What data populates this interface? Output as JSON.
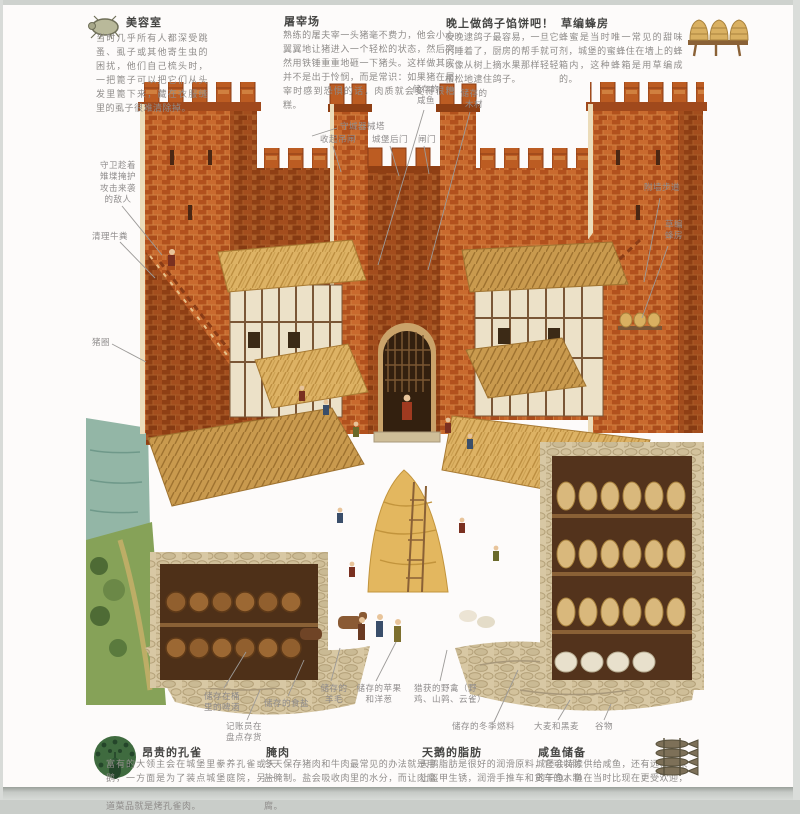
{
  "colors": {
    "brick": "#c9742f",
    "brick_dark": "#a85424",
    "thatch": "#dcb162",
    "stone": "#d6c6a2",
    "grass": "#7d9a50",
    "water": "#8fb3a3",
    "title_text": "#454543",
    "body_text": "#8f8c8a"
  },
  "sections": {
    "beauty": {
      "title": "美容室",
      "icon": "louse-icon",
      "body": "当时几乎所有人都深受跳蚤、虱子或其他寄生虫的困扰，他们自己梳头时，一把篦子可以把它们从头发里篦下来，藏在衣服缝里的虱子很难清除掉。"
    },
    "slaughter": {
      "title": "屠宰场",
      "body": "熟练的屠夫宰一头猪毫不费力，他会小心翼翼地让猪进入一个轻松的状态，然后突然用铁锤重重地砸一下猪头。这样做其实并不是出于怜悯，而是常识：如果猪在屠宰时感到恐惧的话，肉质就会变得很糟糕。"
    },
    "pigeon_pie": {
      "title": "晚上做鸽子馅饼吧！",
      "body": "夜晚逮鸽子最容易，一旦它们睡着了，厨房的帮手就可以像从树上摘水果那样轻轻松松地逮住鸽子。"
    },
    "beehive": {
      "title": "草编蜂房",
      "icon": "beehives-icon",
      "body": "蜂蜜是当时唯一常见的甜味剂，城堡的蜜蜂住在墙上的蜂箱内，这种蜂箱是用草编成的。"
    },
    "peacock": {
      "title": "昂贵的孔雀",
      "icon": "peacock-icon",
      "body": "富有的大领主会在城堡里豢养孔雀或天鹅，一方面是为了装点城堡庭院，另一方面是为了食用，宴会上最受欢迎的一道菜品就是烤孔雀肉。"
    },
    "salted_meat": {
      "title": "腌肉",
      "body": "冬天保存猪肉和牛肉最常见的办法就是用盐腌制。盐会吸收肉里的水分，而让肉腐烂的微生物离不开水分，因此盐可以防腐。"
    },
    "swan_fat": {
      "title": "天鹅的脂肪",
      "body": "天鹅脂肪是很好的润滑原料，它可以防止盔甲生锈，润滑手推车和货车的木制车轴。"
    },
    "salted_fish": {
      "title": "咸鱼储备",
      "icon": "fish-bundle-icon",
      "body": "城堡会持续供给咸鱼，还有远程运来的干鱼。鱼在当时比现在更受欢迎，人们吃鱼的次数几乎和吃肉一样多。"
    }
  },
  "callouts": [
    {
      "text": "守卫趁着\n雉堞掩护\n攻击来袭\n的敌人"
    },
    {
      "text": "清理牛粪"
    },
    {
      "text": "猪圈"
    },
    {
      "text": "守城器械塔"
    },
    {
      "text": "收起吊闸"
    },
    {
      "text": "城堡后门"
    },
    {
      "text": "闸门"
    },
    {
      "text": "储存的\n咸鱼"
    },
    {
      "text": "储存的\n木材"
    },
    {
      "text": "附墙步道"
    },
    {
      "text": "草编\n蜂房"
    },
    {
      "text": "储存在桶\n里的啤酒"
    },
    {
      "text": "记账员在\n盘点存货"
    },
    {
      "text": "储存的食盐"
    },
    {
      "text": "储存的\n羊毛"
    },
    {
      "text": "储存的苹果\n和洋葱"
    },
    {
      "text": "猎获的野禽（野\n鸡、山鹑、云雀）"
    },
    {
      "text": "储存的冬季燃料"
    },
    {
      "text": "大麦和黑麦"
    },
    {
      "text": "谷物"
    }
  ]
}
